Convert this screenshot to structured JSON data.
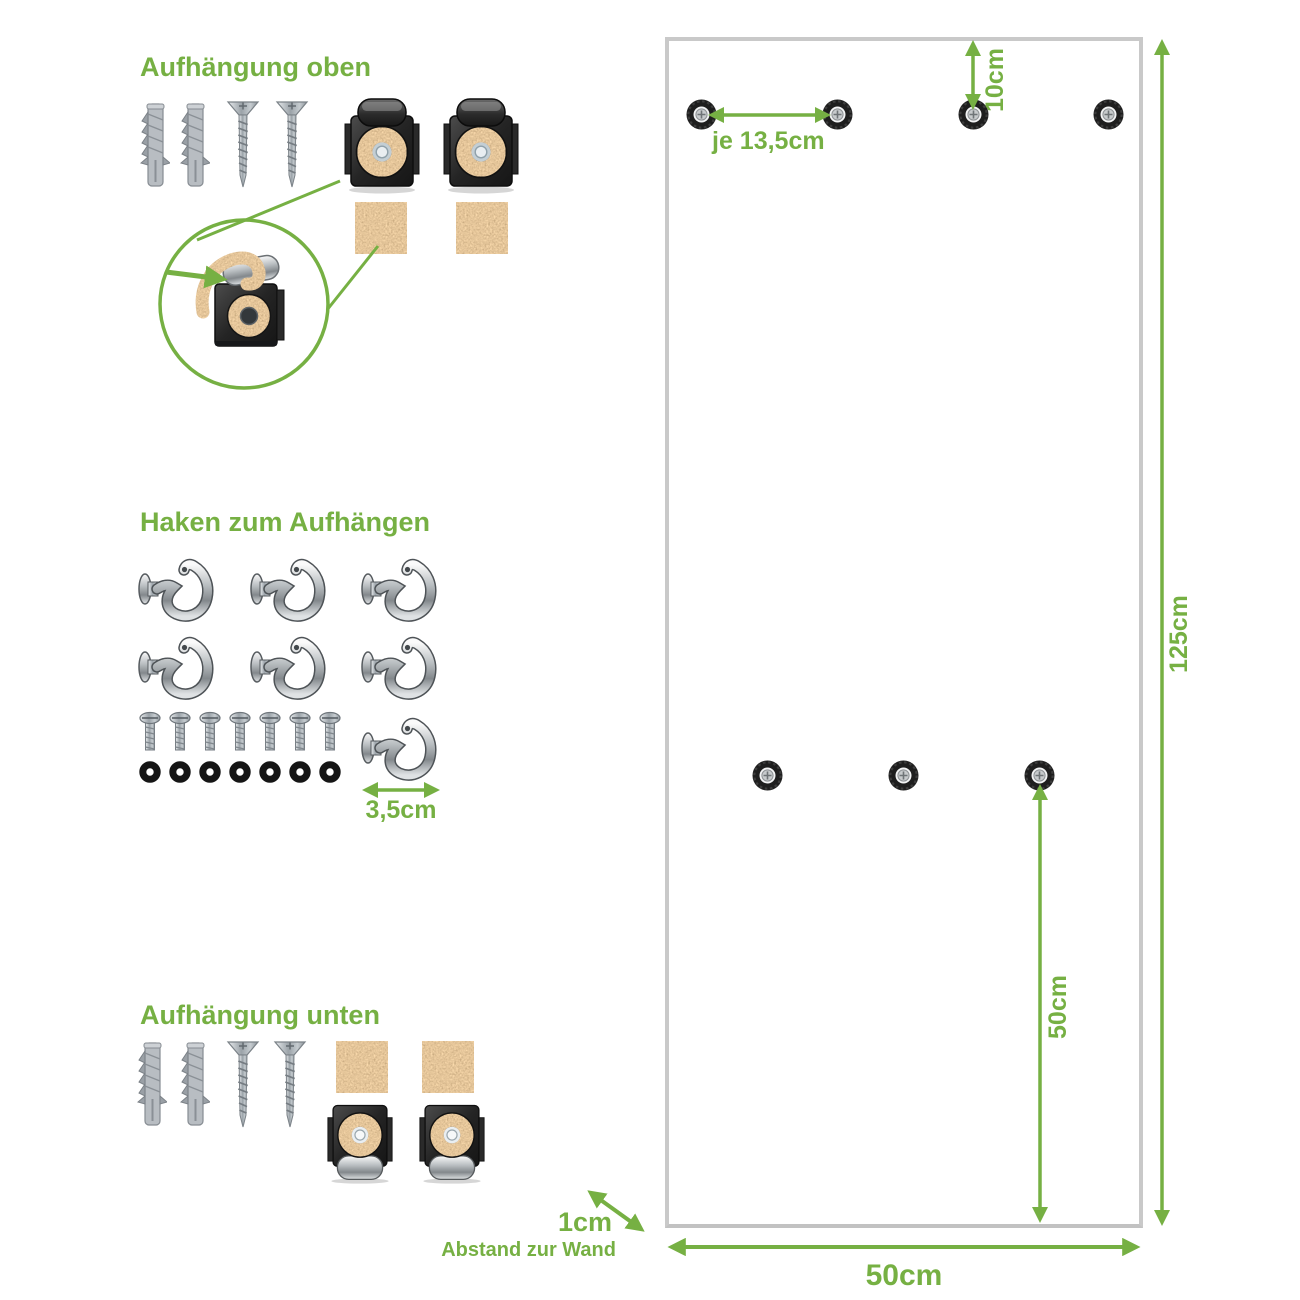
{
  "colors": {
    "accent": "#76b043",
    "panel_border": "#c9c9c9",
    "cork": "#b98a55"
  },
  "sections": {
    "top_mount": {
      "title": "Aufhängung oben",
      "icons": [
        "wall-plug-icon",
        "screw-icon",
        "mounting-clip-icon",
        "cork-pad-icon",
        "detail-magnifier"
      ]
    },
    "hooks": {
      "title": "Haken zum Aufhängen",
      "hook_width": "3,5cm",
      "icons": [
        "hook-icon",
        "bolt-icon",
        "washer-icon"
      ]
    },
    "bottom_mount": {
      "title": "Aufhängung unten",
      "icons": [
        "wall-plug-icon",
        "screw-icon",
        "cork-pad-icon",
        "mounting-clip-icon"
      ]
    }
  },
  "panel": {
    "hole_spacing_label": "je 13,5cm",
    "top_offset_label": "10cm",
    "height_label": "125cm",
    "bottom_offset_label": "50cm",
    "width_label": "50cm",
    "wall_distance_label": "1cm",
    "wall_distance_caption": "Abstand zur Wand"
  }
}
